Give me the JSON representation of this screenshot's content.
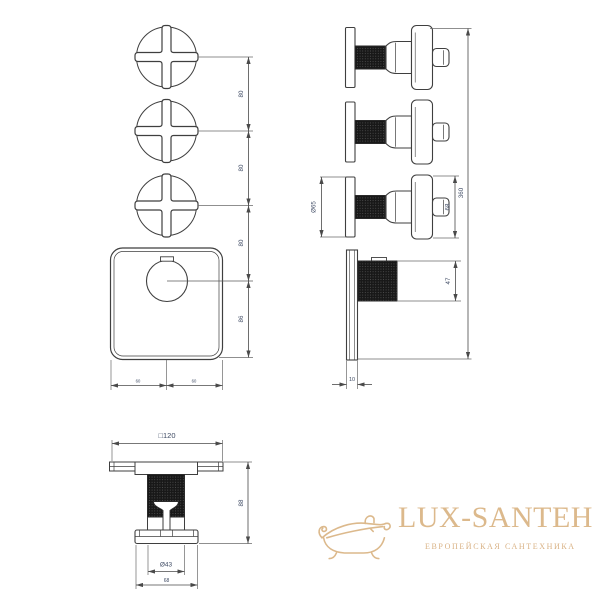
{
  "drawing": {
    "type": "technical-dimension-drawing",
    "subject": "thermostatic shower mixer with 3 cross handles",
    "line_color": "#3f3f3f",
    "dim_text_color": "#3e4a63"
  },
  "dimensions": {
    "front": {
      "spacing_1": "80",
      "spacing_2": "80",
      "spacing_3": "80",
      "knob_offset": "86",
      "bottom_half_left": "60",
      "bottom_half_right": "60"
    },
    "side": {
      "rosette_diameter": "Ø65",
      "handle_length": "68",
      "total_height": "360",
      "knob_depth": "47",
      "plate_thickness": "10"
    },
    "bottom": {
      "plate_square": "□120",
      "overall_height": "88",
      "knob_diameter": "Ø43",
      "handle_width": "68"
    }
  },
  "watermark": {
    "brand": "LUX-SANTEH",
    "tagline": "ЕВРОПЕЙСКАЯ САНТЕХНИКА",
    "color": "#dcb98c",
    "icon": "bathtub-icon"
  }
}
